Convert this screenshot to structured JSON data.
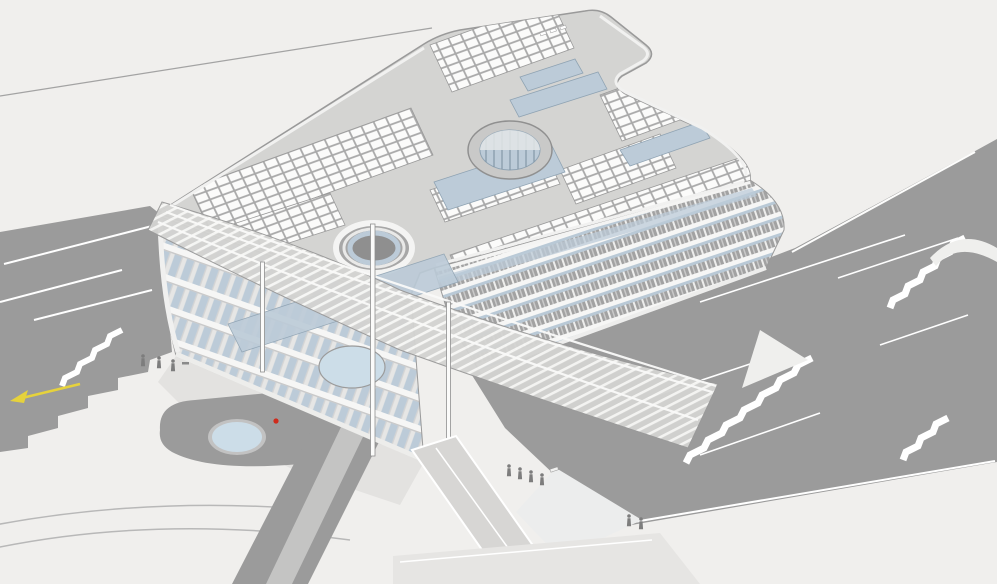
{
  "scene": {
    "title": "Axonometric 3D architectural model view",
    "description": "Bird's-eye axonometric rendering of an office building with rooftop solar panels, circular skylight atrium, curved courtyard, slanted lattice canopy on slender columns, terraced landscape with staircases, two ponds, pedestrian figures, a yellow direction arrow and a red marker dot.",
    "environment": {
      "background": "#f0efed",
      "terrain": "#9b9b9b",
      "path_white": "#ffffff",
      "walkway_light": "#d7d6d4"
    },
    "building": {
      "roof": "#d4d4d2",
      "solar_panel": "#fbfbfa",
      "panel_frame": "#a9a9a9",
      "glazing": "#bccbd8",
      "facade_slab": "#f6f6f5",
      "facade_fin": "#a2a2a2",
      "parapet": "#f2f2f1",
      "floors_visible": 6
    },
    "water": {
      "pond": "#ccdde8",
      "pond_rim": "#b5b5b5",
      "count": 2
    },
    "markers": {
      "direction_arrow": "#e6d23c",
      "direction_arrow_edge": "#b09e1f",
      "point_marker": "#cf2b1c"
    },
    "objects": [
      "rooftop solar array",
      "circular skylight atrium",
      "curved courtyard",
      "slanted lattice canopy",
      "support columns",
      "terraced stairs",
      "entrance walkway",
      "ponds",
      "pedestrian figures"
    ]
  }
}
